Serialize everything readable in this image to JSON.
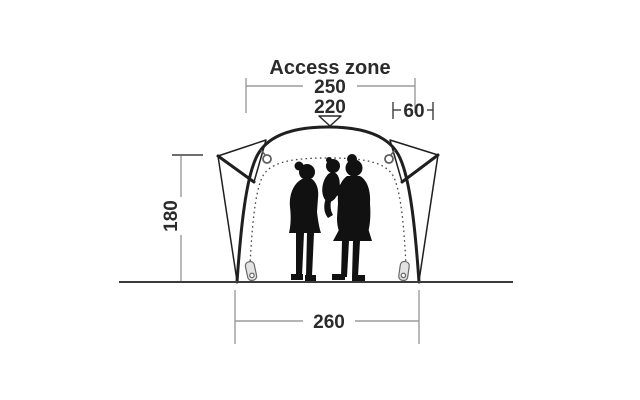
{
  "diagram": {
    "title": "Access zone",
    "dims": {
      "access_zone_width": "250",
      "door_width": "220",
      "side_extension": "60",
      "height": "180",
      "base_width": "260"
    }
  },
  "colors": {
    "ink": "#1f1f1f",
    "dimension_gray": "#9b9b9b",
    "dimension_dark": "#3f3f3f",
    "text": "#2b2b2b",
    "fabric": "#ffffff",
    "silhouette": "#111111",
    "zipper_pull_fill": "#e3e3e3",
    "hardware_gray": "#686868",
    "background": "#ffffff"
  }
}
